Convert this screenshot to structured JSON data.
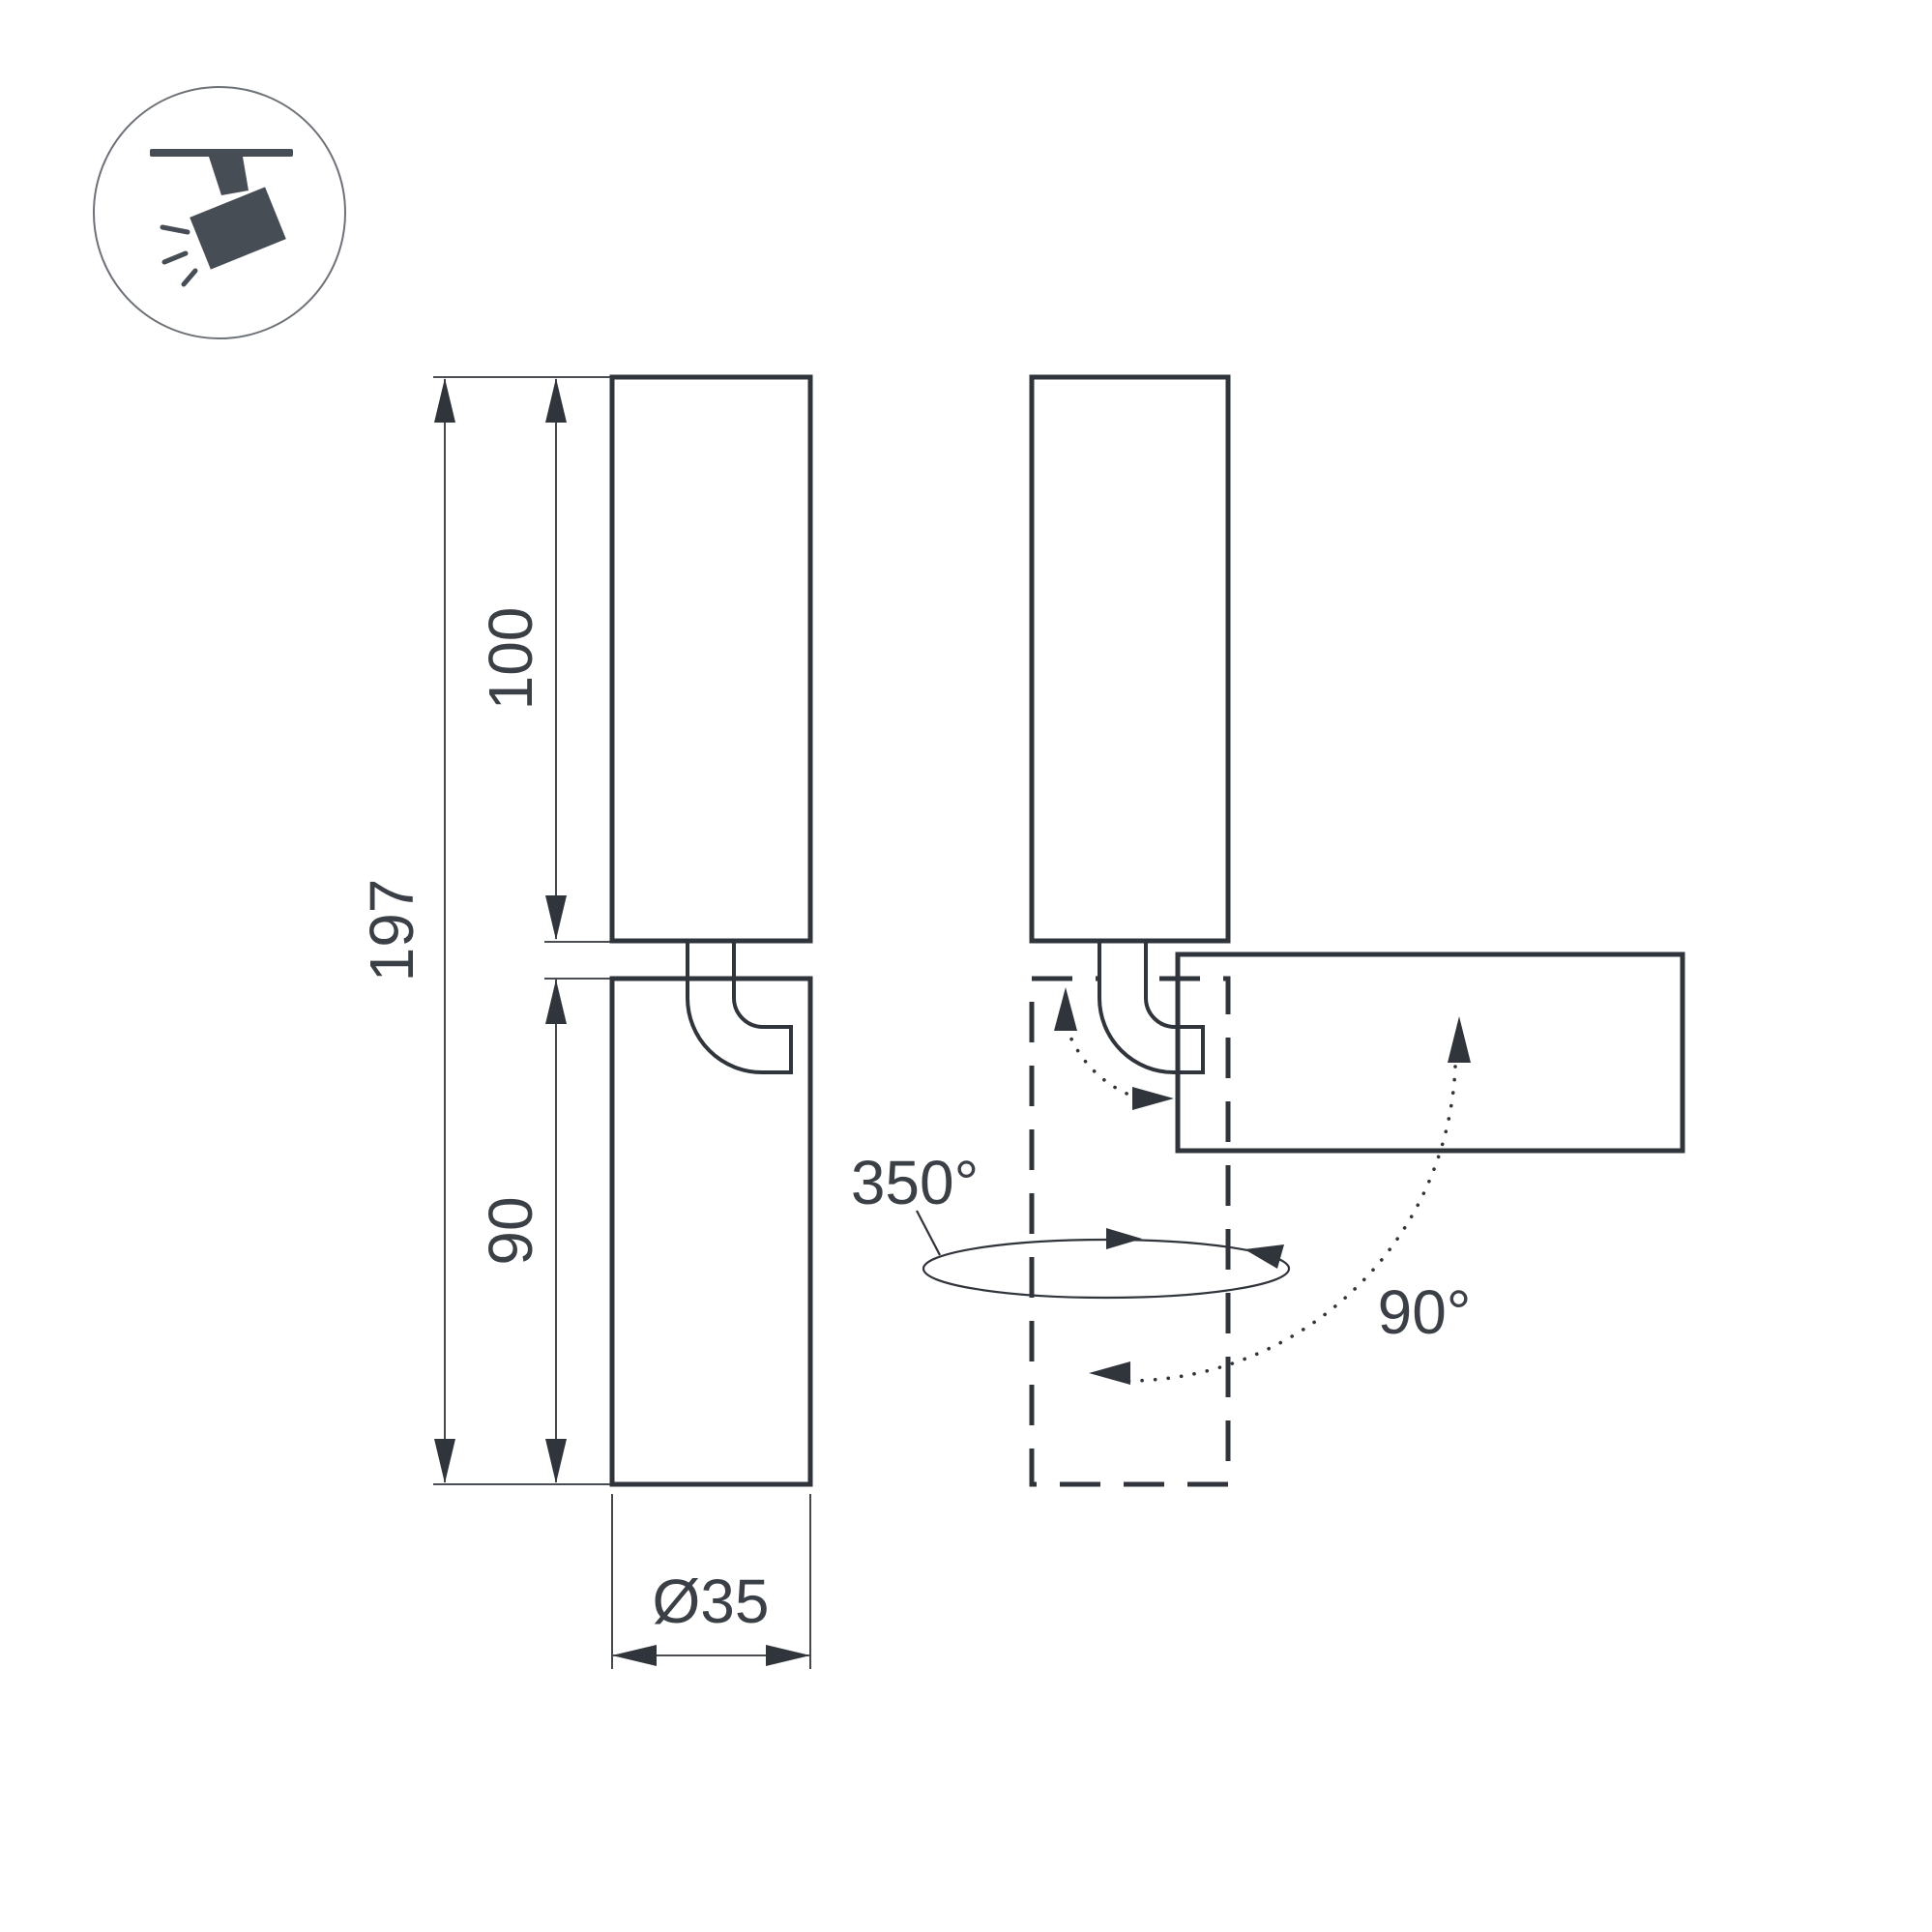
{
  "icon": {
    "label": "track-spotlight"
  },
  "front_view": {
    "dim_total": "197",
    "dim_upper_body": "100",
    "dim_lower_body": "90",
    "dim_diameter": "Ø35"
  },
  "side_view": {
    "swivel_angle": "350°",
    "tilt_angle": "90°"
  },
  "colors": {
    "line": "#30353b",
    "text": "#3b4046",
    "icon": "#474d55",
    "icon-circle": "#6d7278",
    "background": "#ffffff"
  }
}
